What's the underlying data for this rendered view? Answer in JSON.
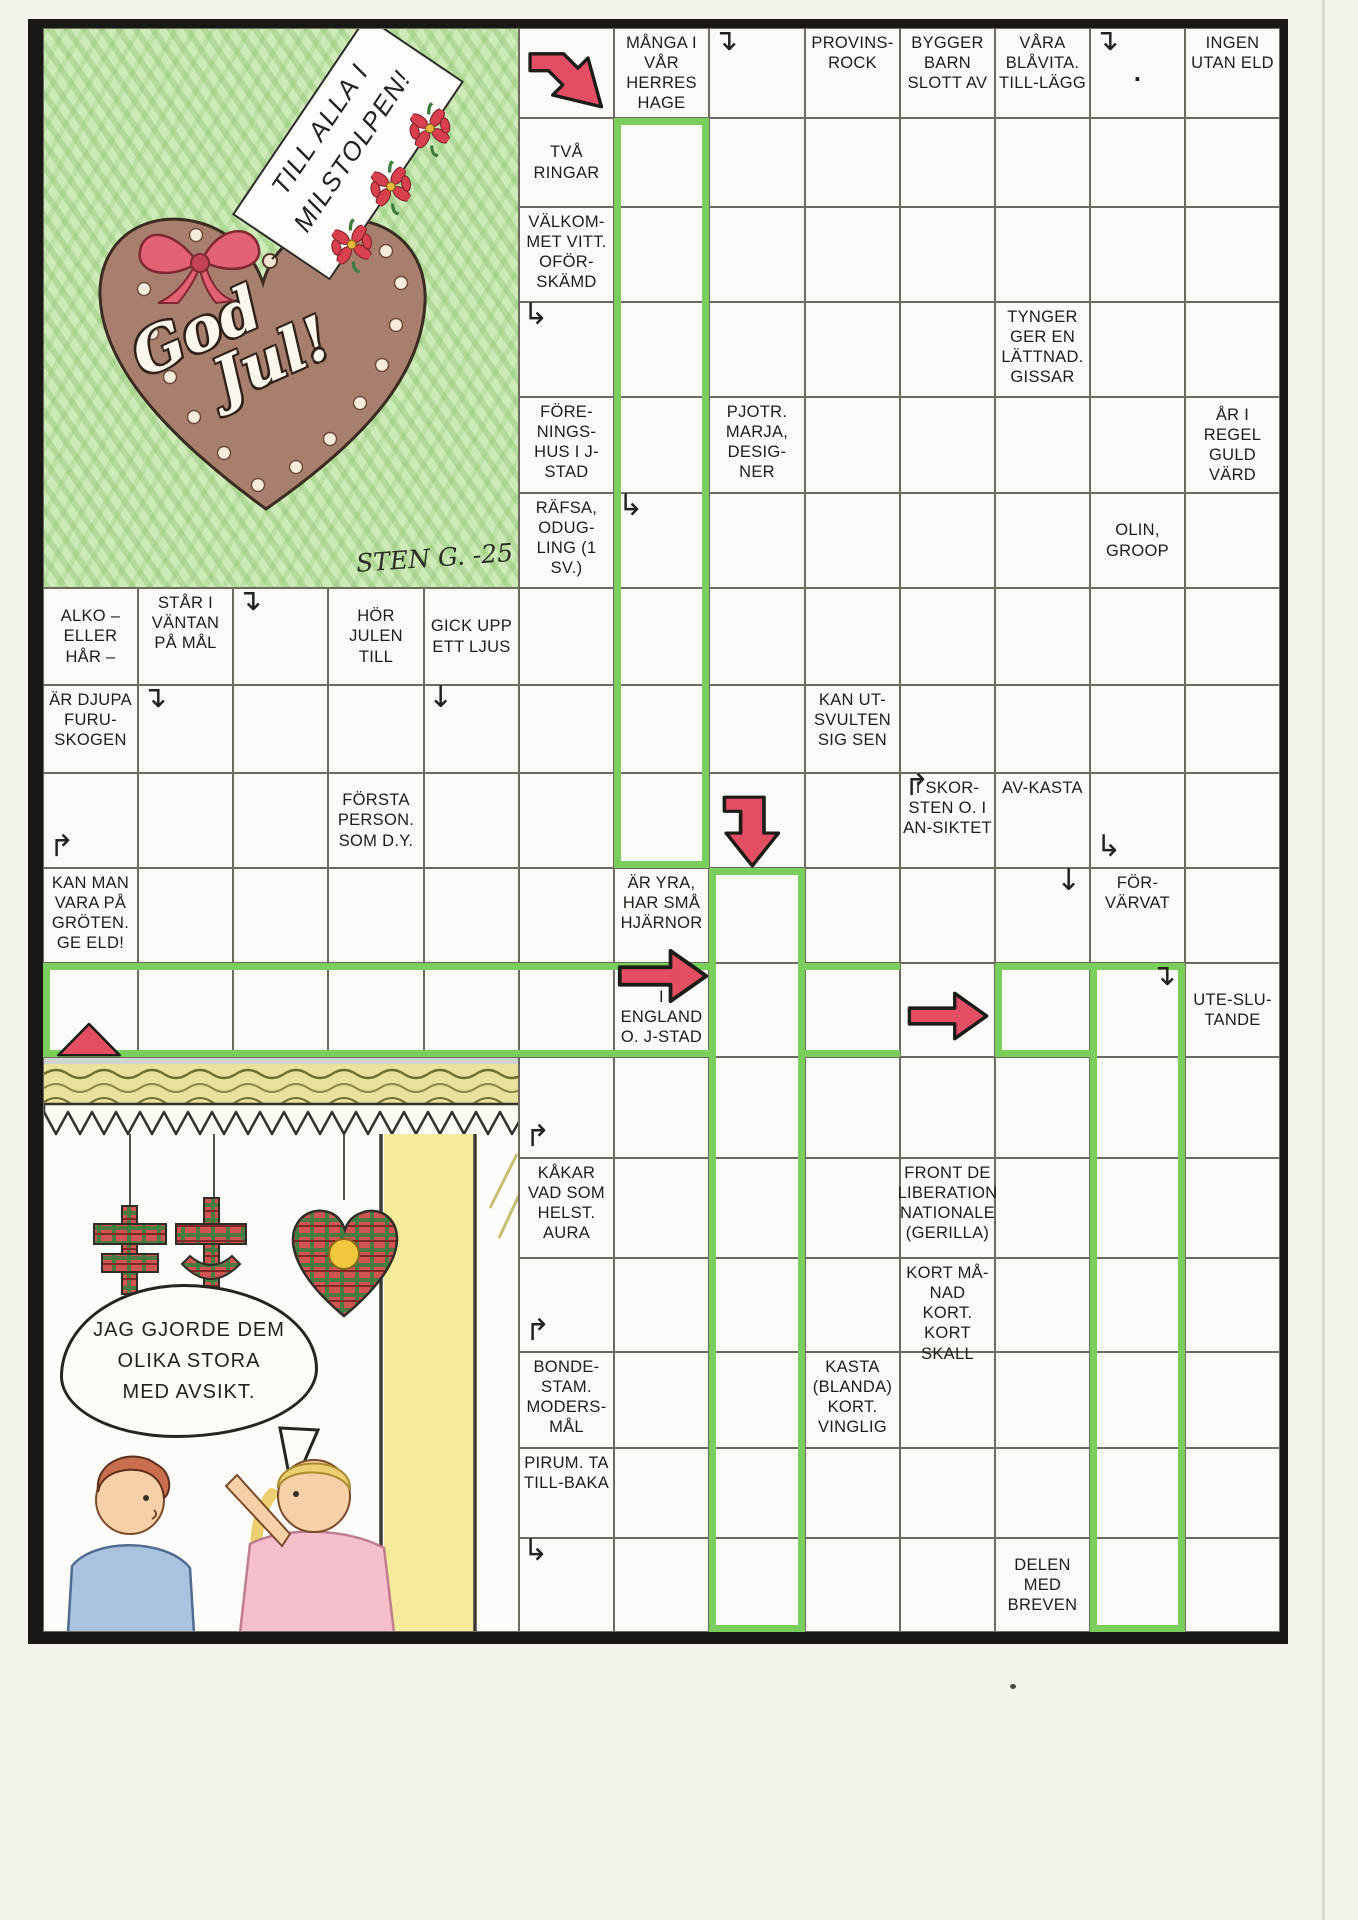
{
  "illustration_top": {
    "tag_line1": "TILL ALLA I",
    "tag_line2": "MILSTOLPEN!",
    "heart_line1": "God",
    "heart_line2": "Jul!",
    "signature": "STEN G. -25"
  },
  "cartoon": {
    "speech_line1": "JAG GJORDE DEM",
    "speech_line2": "OLIKA STORA",
    "speech_line3": "MED AVSIKT."
  },
  "colors": {
    "highlight_green": "#7acf5c",
    "arrow_red": "#e34e63",
    "ink": "#1f1d1a"
  },
  "puzzle": {
    "clues": [
      {
        "c": 7,
        "r": 1,
        "t": "MÅNGA I VÅR HERRES HAGE"
      },
      {
        "c": 9,
        "r": 1,
        "t": "PROVINS-ROCK"
      },
      {
        "c": 10,
        "r": 1,
        "t": "BYGGER BARN SLOTT AV"
      },
      {
        "c": 11,
        "r": 1,
        "t": "VÅRA BLÅVITA. TILL-LÄGG"
      },
      {
        "c": 12,
        "r": 1,
        "t": ".",
        "va": "center"
      },
      {
        "c": 13,
        "r": 1,
        "t": "INGEN UTAN ELD"
      },
      {
        "c": 6,
        "r": 2,
        "t": "TVÅ RINGAR",
        "va": "center"
      },
      {
        "c": 6,
        "r": 3,
        "t": "VÄLKOM-MET VITT. OFÖR-SKÄMD"
      },
      {
        "c": 11,
        "r": 4,
        "t": "TYNGER GER EN LÄTTNAD. GISSAR"
      },
      {
        "c": 6,
        "r": 5,
        "t": "FÖRE-NINGS-HUS I J-STAD"
      },
      {
        "c": 8,
        "r": 5,
        "t": "PJOTR. MARJA, DESIG-NER"
      },
      {
        "c": 13,
        "r": 5,
        "t": "ÅR I REGEL GULD VÄRD",
        "va": "center"
      },
      {
        "c": 6,
        "r": 6,
        "t": "RÄFSA, ODUG-LING (1 SV.)"
      },
      {
        "c": 12,
        "r": 6,
        "t": "OLIN, GROOP",
        "va": "center"
      },
      {
        "c": 1,
        "r": 7,
        "t": "ALKO – ELLER HÅR –",
        "va": "center"
      },
      {
        "c": 2,
        "r": 7,
        "t": "STÅR I VÄNTAN PÅ MÅL"
      },
      {
        "c": 4,
        "r": 7,
        "t": "HÖR JULEN TILL",
        "va": "center"
      },
      {
        "c": 5,
        "r": 7,
        "t": "GICK UPP ETT LJUS",
        "va": "center"
      },
      {
        "c": 1,
        "r": 8,
        "t": "ÄR DJUPA FURU-SKOGEN"
      },
      {
        "c": 9,
        "r": 8,
        "t": "KAN UT-SVULTEN SIG SEN"
      },
      {
        "c": 4,
        "r": 9,
        "t": "FÖRSTA PERSON. SOM D.Y.",
        "va": "center"
      },
      {
        "c": 10,
        "r": 9,
        "t": "I SKOR-STEN O. I AN-SIKTET"
      },
      {
        "c": 11,
        "r": 9,
        "t": "AV-KASTA"
      },
      {
        "c": 1,
        "r": 10,
        "t": "KAN MAN VARA PÅ GRÖTEN. GE ELD!"
      },
      {
        "c": 7,
        "r": 10,
        "t": "ÄR YRA, HAR SMÅ HJÄRNOR"
      },
      {
        "c": 12,
        "r": 10,
        "t": "FÖR-VÄRVAT"
      },
      {
        "c": 7,
        "r": 11,
        "t": "I ENGLAND O. J-STAD",
        "va": "bottom"
      },
      {
        "c": 13,
        "r": 11,
        "t": "UTE-SLU-TANDE",
        "va": "center"
      },
      {
        "c": 6,
        "r": 13,
        "t": "KÅKAR VAD SOM HELST. AURA"
      },
      {
        "c": 10,
        "r": 13,
        "t": "FRONT DE LIBERATION NATIONALE (GERILLA)"
      },
      {
        "c": 10,
        "r": 14,
        "t": "KORT MÅ-NAD KORT. KORT SKALL"
      },
      {
        "c": 6,
        "r": 15,
        "t": "BONDE-STAM. MODERS-MÅL"
      },
      {
        "c": 9,
        "r": 15,
        "t": "KASTA (BLANDA) KORT. VINGLIG"
      },
      {
        "c": 6,
        "r": 16,
        "t": "PIRUM. TA TILL-BAKA"
      },
      {
        "c": 11,
        "r": 17,
        "t": "DELEN MED BREVEN",
        "va": "center"
      }
    ],
    "indicators": [
      {
        "c": 8,
        "r": 1,
        "g": "↴",
        "pos": "tl"
      },
      {
        "c": 12,
        "r": 1,
        "g": "↴",
        "pos": "tl"
      },
      {
        "c": 6,
        "r": 4,
        "g": "↳",
        "pos": "tl"
      },
      {
        "c": 7,
        "r": 6,
        "g": "↳",
        "pos": "tl"
      },
      {
        "c": 3,
        "r": 7,
        "g": "↴",
        "pos": "tl"
      },
      {
        "c": 2,
        "r": 8,
        "g": "↴",
        "pos": "tl"
      },
      {
        "c": 5,
        "r": 8,
        "g": "↓",
        "pos": "tl"
      },
      {
        "c": 1,
        "r": 9,
        "g": "↱",
        "pos": "bl"
      },
      {
        "c": 10,
        "r": 9,
        "g": "↱",
        "pos": "tl"
      },
      {
        "c": 12,
        "r": 9,
        "g": "↳",
        "pos": "bl"
      },
      {
        "c": 11,
        "r": 10,
        "g": "↓",
        "pos": "tr"
      },
      {
        "c": 12,
        "r": 11,
        "g": "↴",
        "pos": "tr"
      },
      {
        "c": 6,
        "r": 12,
        "g": "↱",
        "pos": "bl"
      },
      {
        "c": 6,
        "r": 14,
        "g": "↱",
        "pos": "bl"
      },
      {
        "c": 6,
        "r": 17,
        "g": "↳",
        "pos": "tl"
      }
    ],
    "arrows": [
      {
        "c": 6,
        "r": 1,
        "type": "bent-dr",
        "dx": 6,
        "dy": 4,
        "w": 84,
        "h": 84
      },
      {
        "c": 8,
        "r": 9,
        "type": "elbow-down",
        "dx": 10,
        "dy": 18,
        "w": 72,
        "h": 78
      },
      {
        "c": 7,
        "r": 11,
        "type": "right",
        "dx": 2,
        "dy": -17,
        "w": 94,
        "h": 60
      },
      {
        "c": 10,
        "r": 11,
        "type": "right",
        "dx": 6,
        "dy": 26,
        "w": 84,
        "h": 54
      },
      {
        "c": 1,
        "r": 11,
        "type": "tri-up",
        "dx": 12,
        "dy": 58,
        "w": 68,
        "h": 36
      }
    ],
    "green_runs": [
      {
        "c1": 7,
        "r1": 2,
        "c2": 7,
        "r2": 9,
        "sides": "lrtb"
      },
      {
        "c1": 8,
        "r1": 10,
        "c2": 8,
        "r2": 17,
        "sides": "lrtb"
      },
      {
        "c1": 12,
        "r1": 11,
        "c2": 12,
        "r2": 17,
        "sides": "lrtb"
      },
      {
        "c1": 1,
        "r1": 11,
        "c2": 7,
        "r2": 11,
        "sides": "ltb"
      },
      {
        "c1": 9,
        "r1": 11,
        "c2": 9,
        "r2": 11,
        "sides": "tb"
      },
      {
        "c1": 11,
        "r1": 11,
        "c2": 11,
        "r2": 11,
        "sides": "ltb"
      }
    ]
  }
}
